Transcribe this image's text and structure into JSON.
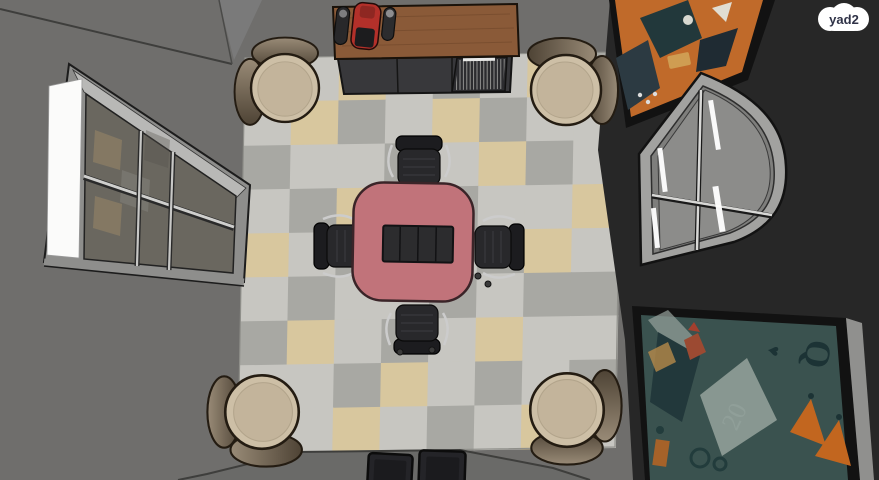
{
  "watermark": {
    "label": "yad2"
  },
  "card_art": {
    "letter": "Q",
    "number": "20"
  },
  "palette": {
    "wall": "#6f6e6c",
    "wall-dark": "#272727",
    "corner-line": "#3e3e3c",
    "rug-edge": "#8f8f8a",
    "table-top": "#c1737a",
    "table-edge": "#3a2428",
    "table-panel": "#2c2c2e",
    "panel-divider": "#121214",
    "office-chair": "#28282b",
    "office-chair-back": "#1c1c1f",
    "metal": "#cccccc",
    "lounge-seat": "#cdbfa6",
    "lounge-seat-inner": "#c3b49b",
    "lounge-back-light": "#998b77",
    "lounge-back-dark": "#4e4335",
    "lounge-outline": "#241c12",
    "wood-top": "#8a5a38",
    "wood-grain": "#744a2c",
    "cabinet-front": "#38383b",
    "rack-dark": "#2c2c2f",
    "rack-line": "#9b9b98",
    "machine-red": "#b3302a",
    "bottle-dark": "#28282a",
    "light-strip": "#fbfbfa",
    "window-frame": "#8e8e8c",
    "window-band": "#b8b8b6",
    "glass": "#6a675f",
    "pane-gray": "#8c8c8a",
    "arch-frame": "#a2a2a0",
    "arch-inner": "#7e7e7c",
    "art-orange": "#c06a2a",
    "art-ink": "#22383b",
    "art-teal": "#3a524f",
    "art-teal-ink": "#1c3335",
    "art-light": "#97a39c",
    "art-amber": "#c2661f",
    "frame-dark": "#121212",
    "frame-side": "#90908e",
    "badge-bg": "#ffffff",
    "badge-text": "#2f3247"
  },
  "rug": {
    "cols": 8,
    "rows": 9,
    "tile_colors": {
      "l": "#c7c6c1",
      "g": "#a8a8a3",
      "t": "#d8c79e"
    },
    "grid": [
      "gltlgltg",
      "ltgltgll",
      "gllgltgl",
      "lgtlgllt",
      "tlgtlgtl",
      "lgllglgg",
      "gtlgltll",
      "llgtlglg",
      "gltlgltl"
    ]
  }
}
